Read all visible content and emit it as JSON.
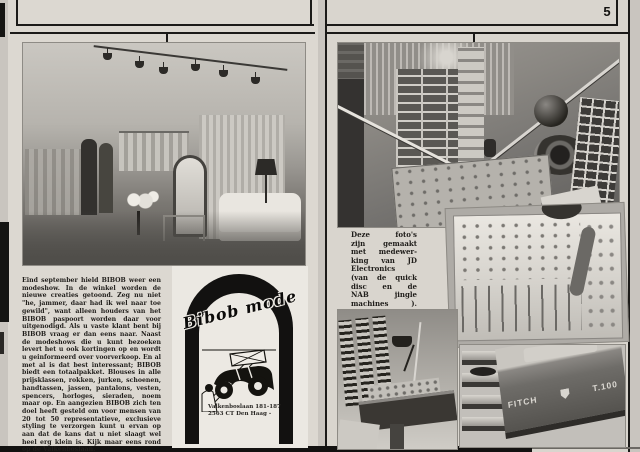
{
  "page_number": "5",
  "left_page": {
    "article": {
      "body": "Eind september hield BIBOB weer een modeshow. In de winkel worden de nieuwe creaties getoond. Zeg nu niet \"he, jammer, daar had ik wel naar toe gewild\", want alleen houders van het BIBOB paspoort worden daar voor uitgenodigd. Als u vaste klant bent bij BIBOB vraag er dan eens naar. Naast de modeshows die u kunt bezoeken levert het u ook kortingen op en wordt u geinformeerd over voorverkoop. En al met al is dat best interessant; BIBOB biedt een totaalpakket. Blouses in alle prijsklassen, rokken, jurken, schoenen, handtassen, jassen, pantalons, vesten, spencers, horloges, sieraden, noem maar op. En aangezien BIBOB zich ten doel heeft gesteld om voor mensen van 20 tot 50 representatieve, exclusieve styling te verzorgen kunt u ervan op aan dat de kans dat u niet slaagt wel heel erg klein is. Kijk maar eens rond op de Valkenboslaan.",
      "signature": "René van Abeelen."
    },
    "photo_semantic": "fashion-boutique-interior-photo",
    "ad": {
      "brand": "Bibob mode",
      "address_line1": "Valkenboslaan 181-187",
      "address_line2": "2563 CT Den Haag -"
    }
  },
  "right_page": {
    "caption_lines": [
      "Deze foto's",
      "zijn gemaakt",
      "met medewer-",
      "king van JD",
      "Electronics",
      "(van de quick",
      "disc en de",
      "NAB jingle",
      "machines )."
    ],
    "photos": {
      "top_semantic": "radio-studio-overview-photo",
      "mixer_semantic": "mixing-console-closeup-photo",
      "desk_semantic": "studio-desk-cart-racks-photo",
      "stack_semantic": "cartridge-machine-stack-photo",
      "cart_machine_brand": "FITCH",
      "cart_machine_model": "T.100"
    }
  },
  "colors": {
    "ink": "#1b1a18",
    "paper": "#dcd8d1",
    "scan_background": "#c9c5bf"
  }
}
